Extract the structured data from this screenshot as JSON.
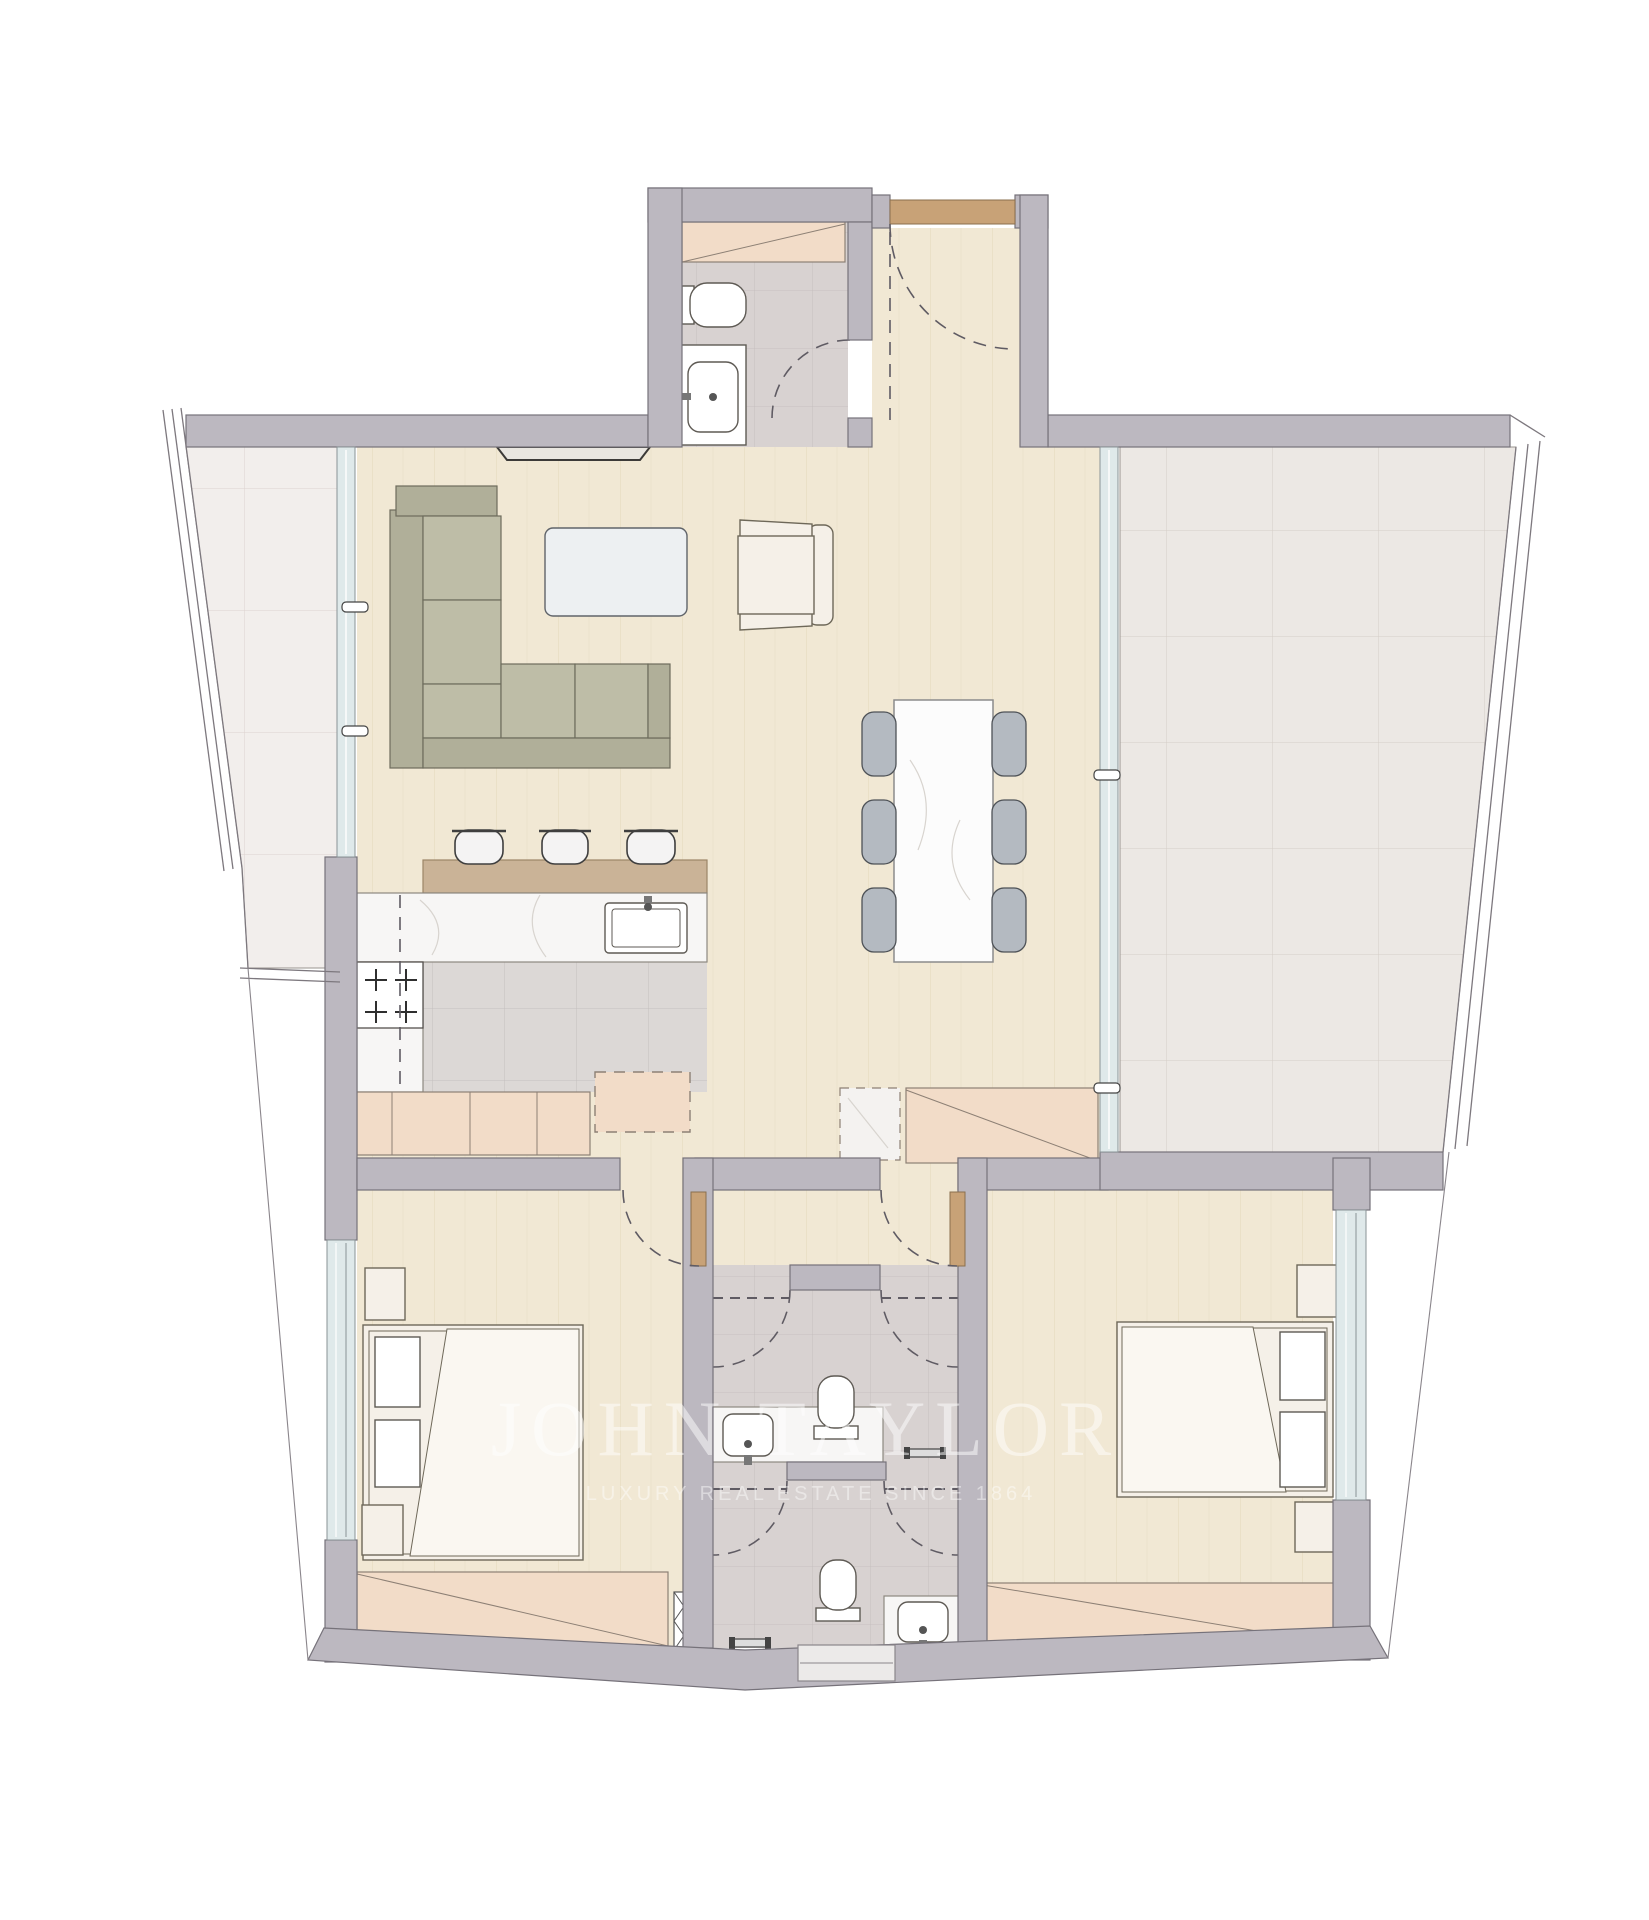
{
  "watermark": {
    "brand": "JOHN TAYLOR",
    "tagline": "LUXURY REAL ESTATE SINCE 1864"
  },
  "palette": {
    "wall": "#bcb8c0",
    "wall_edge": "#76727a",
    "outline": "#5f5b63",
    "wood": "#f1e8d4",
    "terrace_left": "#f2eeec",
    "terrace_right": "#ece8e4",
    "bath": "#d8d2d1",
    "kitchen_floor": "#dcd8d6",
    "marble": "#f7f6f5",
    "counter_wood": "#cab397",
    "cabinet": "#f2dcc8",
    "door": "#c8a277",
    "glass": "#dfe9ea",
    "glass_frame": "#8a9396",
    "sofa_back": "#b0af99",
    "sofa_seat": "#bebda7",
    "sofa_edge": "#6d6c5c",
    "cream": "#f5f0e8",
    "cream_edge": "#6e6859",
    "table_top": "#fcfcfc",
    "chair": "#b4bac1",
    "chair_edge": "#4e5257",
    "coffee_table": "#edf0f2",
    "fixture": "#ffffff",
    "watermark": "#ffffff"
  }
}
